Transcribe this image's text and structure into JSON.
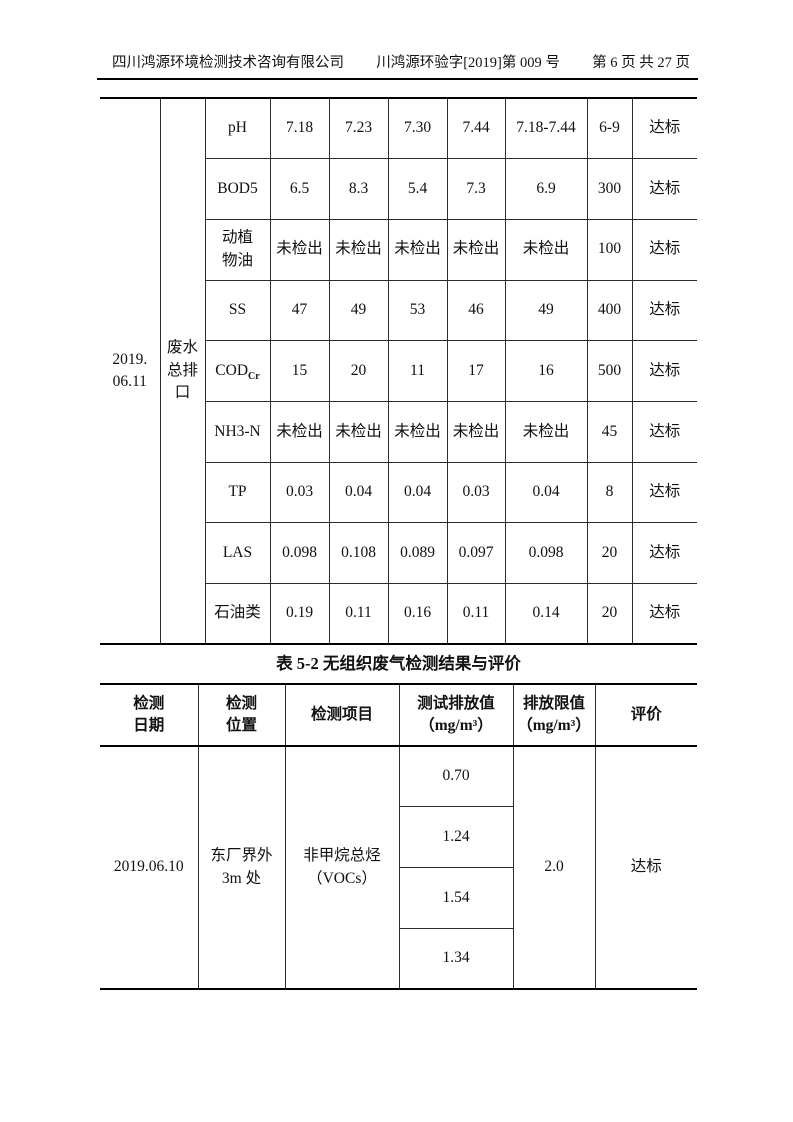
{
  "header": {
    "company": "四川鸿源环境检测技术咨询有限公司",
    "doc_number": "川鸿源环验字[2019]第 009 号",
    "page_info": "第 6 页 共 27 页"
  },
  "table1": {
    "date": "2019.\n06.11",
    "location": "废水\n总排\n口",
    "rows": [
      {
        "param": "pH",
        "values": [
          "7.18",
          "7.23",
          "7.30",
          "7.44"
        ],
        "avg": "7.18-7.44",
        "limit": "6-9",
        "eval": "达标"
      },
      {
        "param": "BOD5",
        "values": [
          "6.5",
          "8.3",
          "5.4",
          "7.3"
        ],
        "avg": "6.9",
        "limit": "300",
        "eval": "达标"
      },
      {
        "param": "动植\n物油",
        "values": [
          "未检出",
          "未检出",
          "未检出",
          "未检出"
        ],
        "avg": "未检出",
        "limit": "100",
        "eval": "达标"
      },
      {
        "param": "SS",
        "values": [
          "47",
          "49",
          "53",
          "46"
        ],
        "avg": "49",
        "limit": "400",
        "eval": "达标"
      },
      {
        "param": "COD",
        "param_sub": "Cr",
        "values": [
          "15",
          "20",
          "11",
          "17"
        ],
        "avg": "16",
        "limit": "500",
        "eval": "达标"
      },
      {
        "param": "NH3-N",
        "values": [
          "未检出",
          "未检出",
          "未检出",
          "未检出"
        ],
        "avg": "未检出",
        "limit": "45",
        "eval": "达标"
      },
      {
        "param": "TP",
        "values": [
          "0.03",
          "0.04",
          "0.04",
          "0.03"
        ],
        "avg": "0.04",
        "limit": "8",
        "eval": "达标"
      },
      {
        "param": "LAS",
        "values": [
          "0.098",
          "0.108",
          "0.089",
          "0.097"
        ],
        "avg": "0.098",
        "limit": "20",
        "eval": "达标"
      },
      {
        "param": "石油类",
        "values": [
          "0.19",
          "0.11",
          "0.16",
          "0.11"
        ],
        "avg": "0.14",
        "limit": "20",
        "eval": "达标"
      }
    ]
  },
  "table2": {
    "title": "表 5-2 无组织废气检测结果与评价",
    "headers": [
      "检测\n日期",
      "检测\n位置",
      "检测项目",
      "测试排放值\n（mg/m³）",
      "排放限值\n（mg/m³）",
      "评价"
    ],
    "row": {
      "date": "2019.06.10",
      "location": "东厂界外\n3m 处",
      "item": "非甲烷总烃\n（VOCs）",
      "values": [
        "0.70",
        "1.24",
        "1.54",
        "1.34"
      ],
      "limit": "2.0",
      "eval": "达标"
    }
  }
}
